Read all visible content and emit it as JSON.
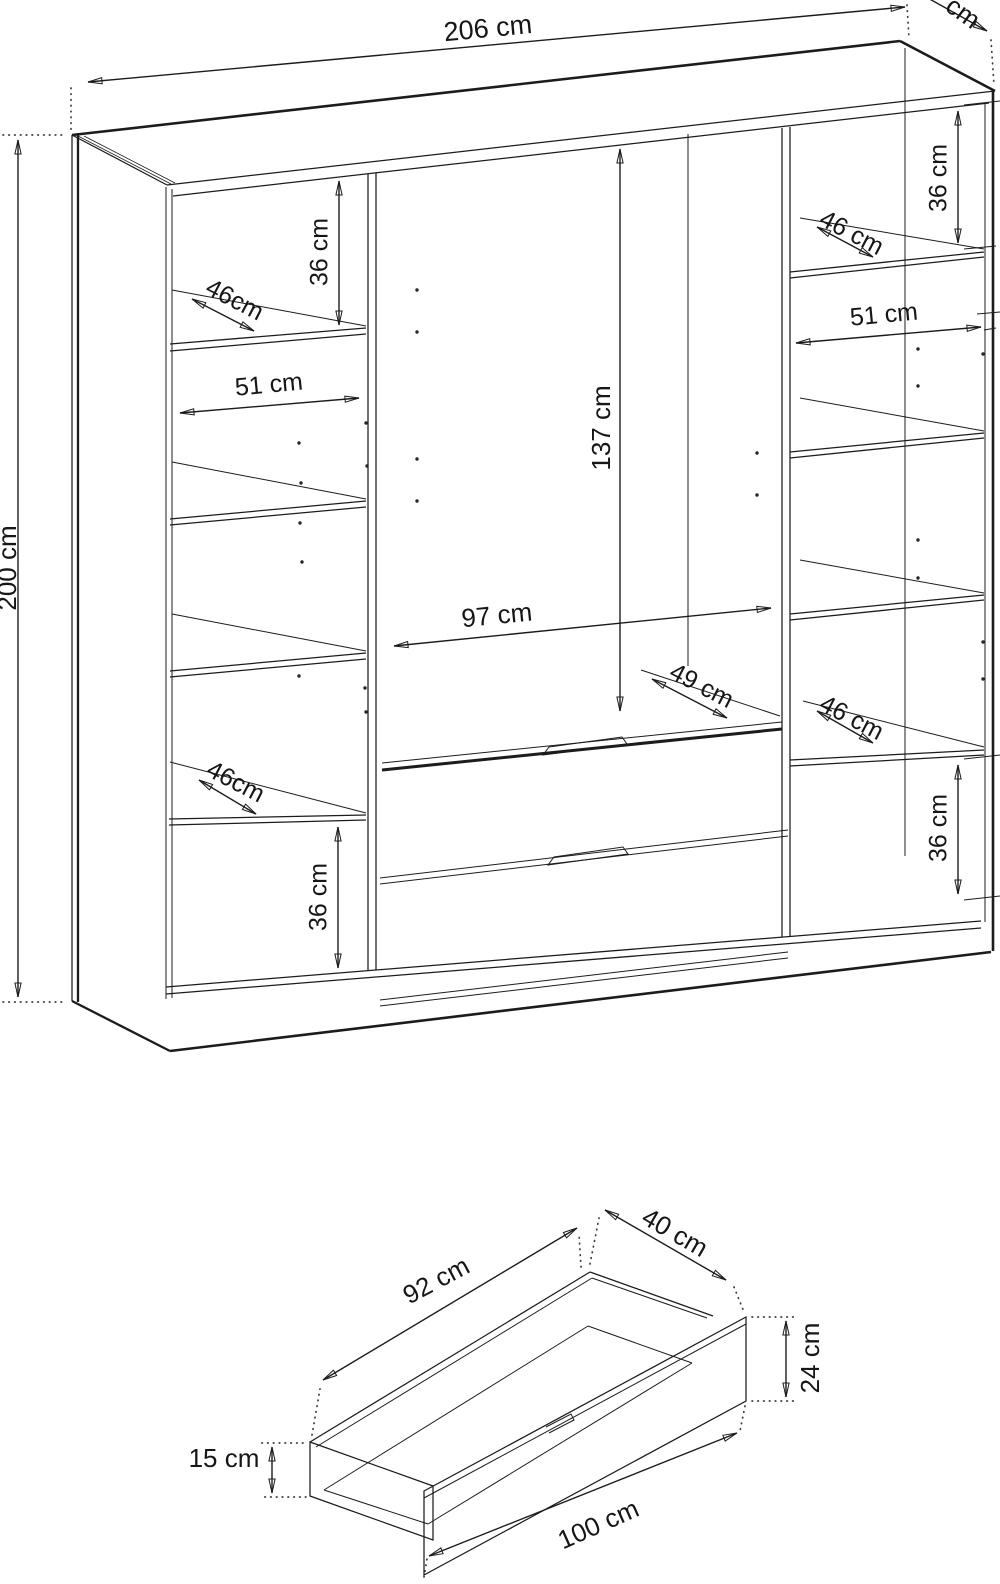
{
  "wardrobe": {
    "overall": {
      "width": "206 cm",
      "height": "200 cm",
      "depth_partial": "cm"
    },
    "middle": {
      "hanging_height": "137 cm",
      "hanging_width": "97 cm",
      "shelf_depth": "49 cm"
    },
    "left_column": {
      "top_gap": "36 cm",
      "top_shelf_depth": "46cm",
      "shelf_width": "51 cm",
      "bottom_shelf_depth": "46cm",
      "bottom_gap": "36 cm"
    },
    "right_column": {
      "top_gap": "36 cm",
      "top_shelf_depth": "46 cm",
      "shelf_width": "51 cm",
      "bottom_shelf_depth": "46 cm",
      "bottom_gap": "36 cm"
    }
  },
  "drawer": {
    "inner_width": "92 cm",
    "depth": "40 cm",
    "front_height": "24 cm",
    "side_height": "15 cm",
    "outer_width": "100 cm"
  }
}
